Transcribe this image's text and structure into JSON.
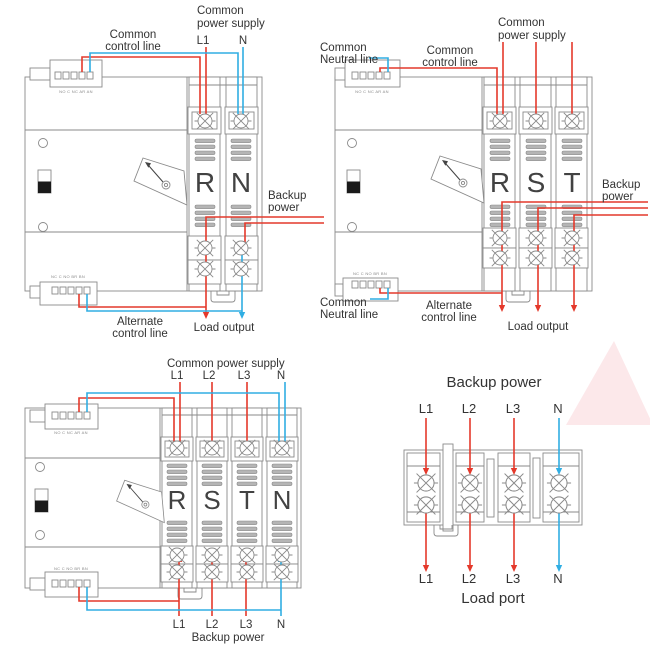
{
  "colors": {
    "wire_red": "#e4392b",
    "wire_blue": "#30aee3",
    "outline_gray": "#8a8a8a",
    "label_text": "#333333",
    "watermark_pink": "#fce8ea"
  },
  "ats_2p": {
    "common_power_supply": [
      "Common",
      "power supply"
    ],
    "input_terminals": [
      "L1",
      "N"
    ],
    "common_control": [
      "Common",
      "control line"
    ],
    "poles": [
      "R",
      "N"
    ],
    "backup": [
      "Backup",
      "power"
    ],
    "alternate_control": [
      "Alternate",
      "control line"
    ],
    "load_output": "Load output",
    "connector_top": "NO C NC AR AN",
    "connector_bottom": "NC C NO BR BN"
  },
  "ats_3p": {
    "common_neutral_top": [
      "Common",
      "Neutral line"
    ],
    "common_control": [
      "Common",
      "control line"
    ],
    "common_power_supply": [
      "Common",
      "power supply"
    ],
    "poles": [
      "R",
      "S",
      "T"
    ],
    "backup": [
      "Backup",
      "power"
    ],
    "common_neutral_bottom": [
      "Common",
      "Neutral line"
    ],
    "alternate_control": [
      "Alternate",
      "control line"
    ],
    "load_output": "Load output",
    "connector_top": "NO C NC AR AN",
    "connector_bottom": "NC C NO BR BN"
  },
  "ats_4p": {
    "common_power_supply": "Common power supply",
    "input_terminals": [
      "L1",
      "L2",
      "L3",
      "N"
    ],
    "poles": [
      "R",
      "S",
      "T",
      "N"
    ],
    "output_terminals": [
      "L1",
      "L2",
      "L3",
      "N"
    ],
    "backup_power": "Backup power",
    "connector_top": "NO C NC AR AN",
    "connector_bottom": "NC C NO BR BN"
  },
  "terminal_block": {
    "title": "Backup power",
    "inputs": [
      "L1",
      "L2",
      "L3",
      "N"
    ],
    "outputs": [
      "L1",
      "L2",
      "L3",
      "N"
    ],
    "load_label": "Load port"
  }
}
